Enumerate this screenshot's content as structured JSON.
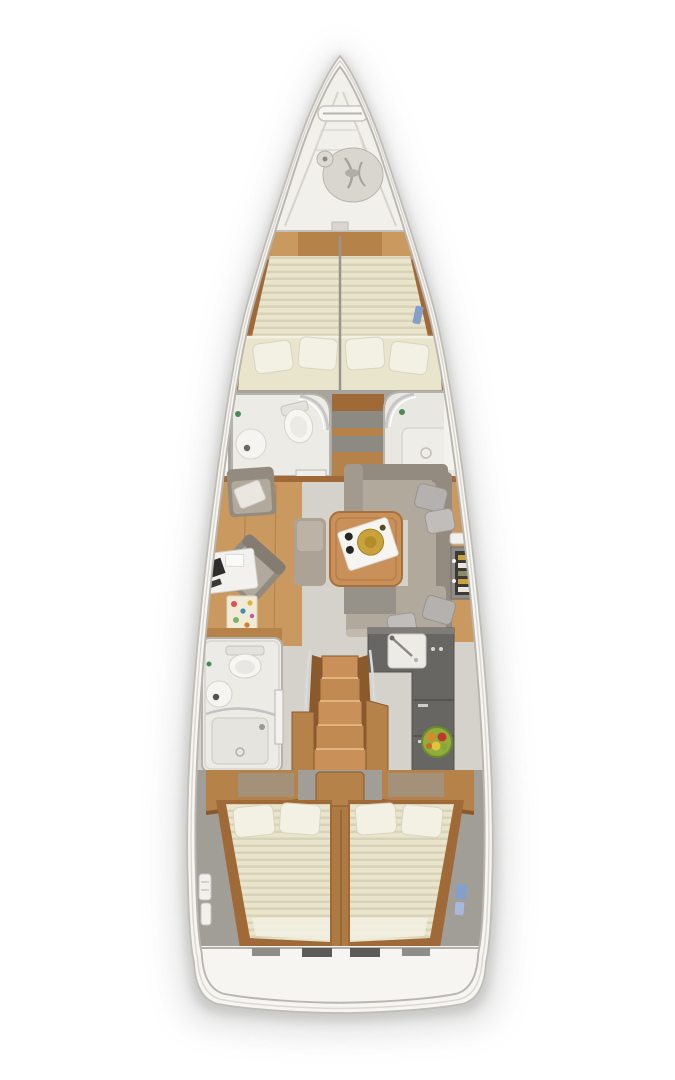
{
  "palette": {
    "hull": "#f6f5f1",
    "hullLine": "#c0bdb7",
    "shadow": "#a6a6a4",
    "deck": "#f1f0ea",
    "wood": "#b5824a",
    "woodLight": "#c9995f",
    "woodDark": "#8a5a2c",
    "woodTrim": "#a06a38",
    "bedding": "#e9e5cd",
    "beddingStripe": "#d8d3b7",
    "linen": "#f3f1e4",
    "floor": "#d5d2cb",
    "wall": "#a7a39d",
    "bath": "#edebe6",
    "sofa": "#b2a99d",
    "sofaBack": "#948b80",
    "pillowGray": "#b5b1ae",
    "counter": "#676663",
    "steel": "#d6d6d8",
    "tableWood": "#c9905a",
    "accentBlue": "#84a0ca",
    "accentGreen": "#4c8a50",
    "bowlGreen": "#8fae3e",
    "gold": "#c9a23c",
    "rugRed": "#d9534f",
    "rugBlue": "#3f8fb0",
    "rugYellow": "#e2b33c",
    "rugGreen": "#7fb069"
  },
  "plan": {
    "view": "top-down-interior-floor-plan",
    "vessel_type": "sailing-yacht",
    "orientation": "bow-up",
    "areas": [
      {
        "id": "anchor-locker",
        "items": [
          "bow-roller",
          "anchor-rode-coil",
          "mooring-cleat"
        ]
      },
      {
        "id": "forward-cabin",
        "items": [
          "split-v-berth",
          "four-pillows",
          "deck-hatch"
        ]
      },
      {
        "id": "forward-head",
        "side": "port",
        "items": [
          "toilet",
          "round-sink",
          "curved-shower-glass",
          "door"
        ]
      },
      {
        "id": "forward-shower",
        "side": "starboard",
        "items": [
          "shower-tray",
          "bench",
          "curved-shower-glass",
          "door"
        ]
      },
      {
        "id": "midship-wardrobe",
        "items": [
          "lockers",
          "shelves"
        ]
      },
      {
        "id": "salon",
        "items": [
          "u-shaped-sofa",
          "coffee-table",
          "serving-tray",
          "ottoman",
          "armchair",
          "lounge-chair",
          "desk-with-laptop",
          "area-rug",
          "bottle-rack",
          "throw-pillows"
        ]
      },
      {
        "id": "galley",
        "side": "starboard",
        "items": [
          "l-shaped-counter",
          "sink",
          "stowage-fronts",
          "fruit-bowl"
        ]
      },
      {
        "id": "aft-head",
        "side": "port",
        "items": [
          "toilet",
          "round-sink",
          "shower-tray",
          "curved-shower-glass",
          "door"
        ]
      },
      {
        "id": "companionway",
        "items": [
          "five-steps",
          "handrails",
          "side-cabinets",
          "engine-box"
        ]
      },
      {
        "id": "aft-cabin-port",
        "items": [
          "double-berth",
          "two-pillows",
          "locker"
        ]
      },
      {
        "id": "aft-cabin-starboard",
        "items": [
          "double-berth",
          "two-pillows",
          "locker"
        ]
      },
      {
        "id": "side-decks",
        "items": [
          "teak-planking",
          "jib-tracks",
          "rope-clutches",
          "fenders"
        ]
      },
      {
        "id": "transom",
        "items": [
          "bathing-platform",
          "footboards"
        ]
      }
    ]
  }
}
